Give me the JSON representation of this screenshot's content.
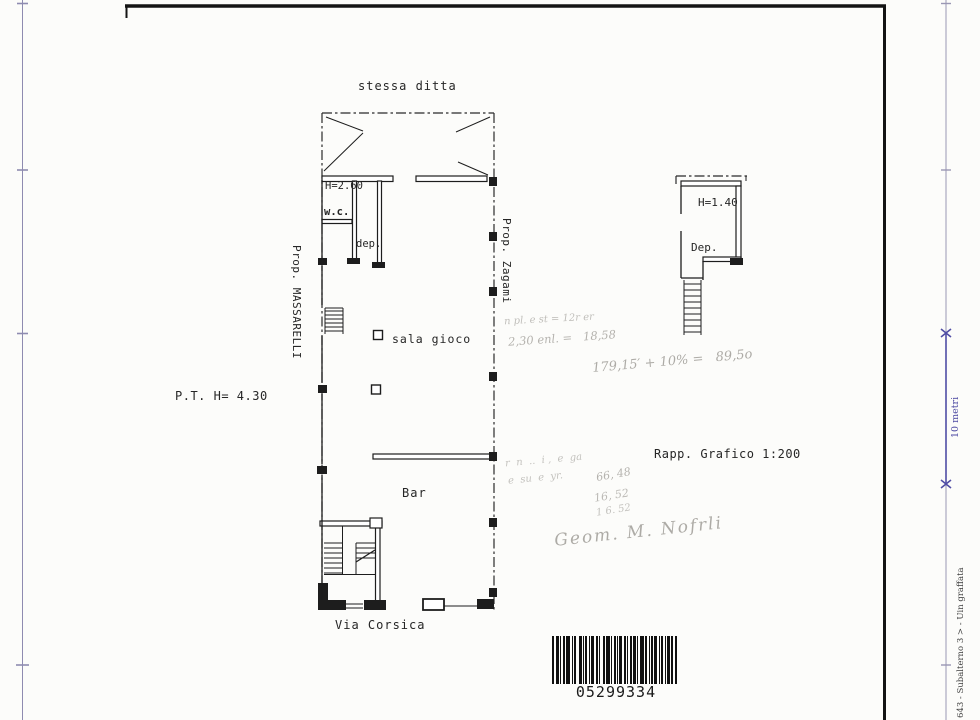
{
  "document": {
    "type": "cadastral floor plan scan",
    "paper_color": "#fcfcfa",
    "ink_color": "#1d1d1d",
    "scale_mark_color": "#4c49a2",
    "pencil_color": "#6e6a63"
  },
  "labels": {
    "stessa_ditta": "stessa ditta",
    "pt_height": "P.T. H= 4.30",
    "prop_left": "Prop. MASSARELLI",
    "prop_right": "Prop. Zagami",
    "h_wc": "H=2.60",
    "wc": "w.c.",
    "dep_small": "dep.",
    "sala_gioco": "sala gioco",
    "bar": "Bar",
    "via_corsica": "Via Corsica",
    "h_dep": "H=1.40",
    "dep_big": "Dep.",
    "scale_note": "Rapp. Grafico 1:200"
  },
  "edge": {
    "scale_bar_label": "10 metri",
    "doc_ref": "643 - Subalterno 3 > - Uin graffata"
  },
  "handwriting": {
    "calc1": "n pl. e st = 12r er",
    "calc2": "2,30 enl. =   18,58",
    "calc3": "179,15′ + 10% =   89,5o",
    "calc4": "r  n  ..  i ,  e  ga",
    "calc5": "e  su  e  yr.",
    "calc6": "66, 48",
    "calc7": "16, 52",
    "calc8": "1 6. 52",
    "signature": "Geom. M. Nofrli"
  },
  "barcode": {
    "number": "05299334",
    "bars": [
      2,
      2,
      3,
      1,
      1,
      2,
      2,
      1,
      4,
      2,
      1,
      1,
      2,
      3,
      3,
      1,
      1,
      1,
      2,
      2,
      1,
      1,
      3,
      2,
      2,
      1,
      1,
      3,
      2,
      1,
      4,
      1,
      1,
      2,
      2,
      1,
      1,
      1,
      3,
      2,
      2,
      1,
      1,
      2,
      2,
      1,
      3,
      1,
      1,
      2,
      4,
      1,
      2,
      2,
      1,
      1,
      2,
      1,
      3,
      2,
      1,
      1,
      2,
      2,
      1,
      1,
      3,
      1,
      2,
      2,
      2,
      0
    ]
  }
}
